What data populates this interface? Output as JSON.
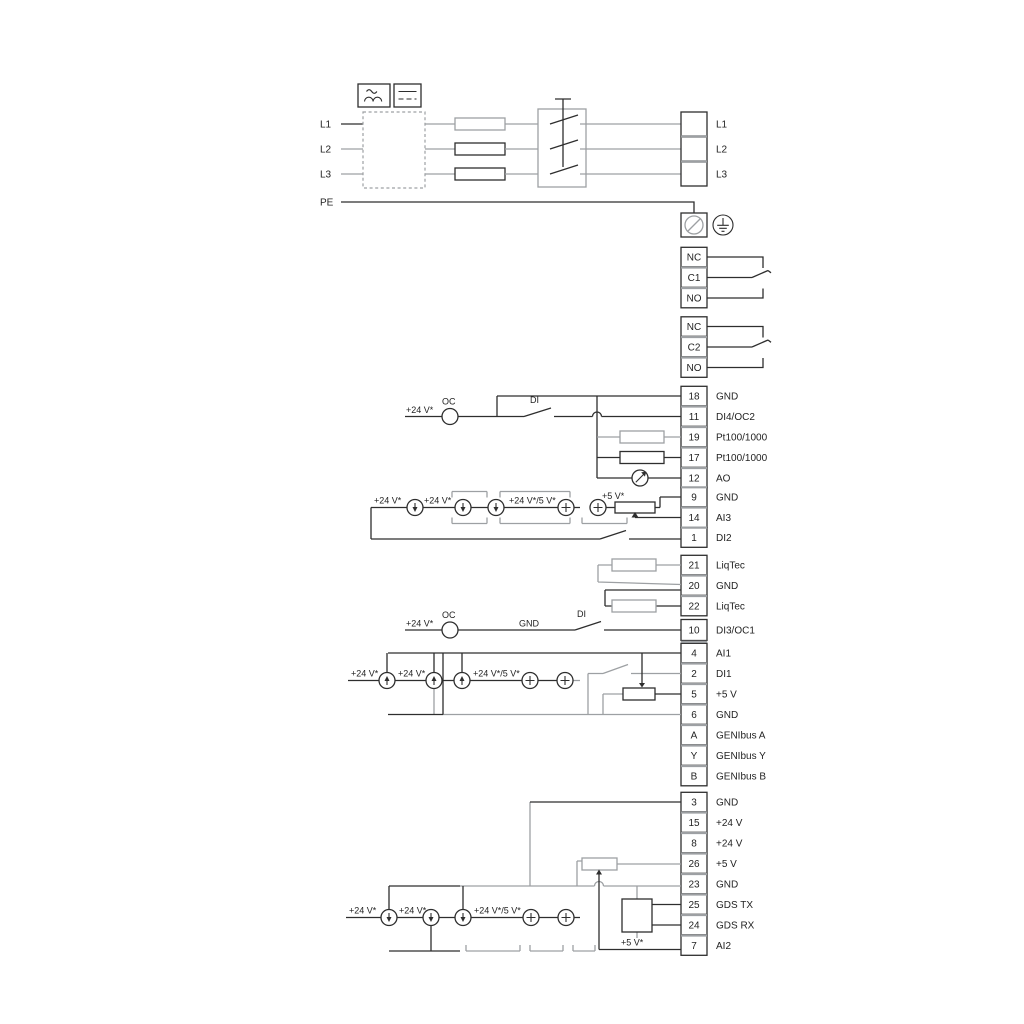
{
  "colors": {
    "line": "#2e2e2e",
    "gray": "#9da0a3",
    "background": "#ffffff"
  },
  "mains": {
    "inputs": [
      {
        "label": "L1"
      },
      {
        "label": "L2"
      },
      {
        "label": "L3"
      },
      {
        "label": "PE"
      }
    ],
    "outputs": [
      {
        "label": "L1"
      },
      {
        "label": "L2"
      },
      {
        "label": "L3"
      }
    ]
  },
  "relay1": {
    "terminals": [
      {
        "label": "NC"
      },
      {
        "label": "C1"
      },
      {
        "label": "NO"
      }
    ]
  },
  "relay2": {
    "terminals": [
      {
        "label": "NC"
      },
      {
        "label": "C2"
      },
      {
        "label": "NO"
      }
    ]
  },
  "strips": {
    "a": {
      "terminals": [
        {
          "num": "18",
          "label": "GND"
        },
        {
          "num": "11",
          "label": "DI4/OC2"
        },
        {
          "num": "19",
          "label": "Pt100/1000"
        },
        {
          "num": "17",
          "label": "Pt100/1000"
        },
        {
          "num": "12",
          "label": "AO"
        }
      ],
      "annotations": {
        "v24": "+24 V*",
        "oc": "OC",
        "di": "DI"
      }
    },
    "b": {
      "terminals": [
        {
          "num": "9",
          "label": "GND"
        },
        {
          "num": "14",
          "label": "AI3"
        },
        {
          "num": "1",
          "label": "DI2"
        }
      ],
      "annotations": {
        "v24_1": "+24 V*",
        "v24_2": "+24 V*",
        "v24_5": "+24 V*/5 V*",
        "v5": "+5 V*"
      }
    },
    "c": {
      "terminals": [
        {
          "num": "21",
          "label": "LiqTec"
        },
        {
          "num": "20",
          "label": "GND"
        },
        {
          "num": "22",
          "label": "LiqTec"
        }
      ]
    },
    "d": {
      "terminals": [
        {
          "num": "10",
          "label": "DI3/OC1"
        }
      ],
      "annotations": {
        "v24": "+24 V*",
        "oc": "OC",
        "gnd": "GND",
        "di": "DI"
      }
    },
    "e": {
      "terminals": [
        {
          "num": "4",
          "label": "AI1"
        },
        {
          "num": "2",
          "label": "DI1"
        },
        {
          "num": "5",
          "label": "+5 V"
        },
        {
          "num": "6",
          "label": "GND"
        },
        {
          "num": "A",
          "label": "GENIbus A"
        },
        {
          "num": "Y",
          "label": "GENIbus Y"
        },
        {
          "num": "B",
          "label": "GENIbus B"
        }
      ],
      "annotations": {
        "v24_1": "+24 V*",
        "v24_2": "+24 V*",
        "v24_5": "+24 V*/5 V*"
      }
    },
    "f": {
      "terminals": [
        {
          "num": "3",
          "label": "GND"
        },
        {
          "num": "15",
          "label": "+24 V"
        },
        {
          "num": "8",
          "label": "+24 V"
        },
        {
          "num": "26",
          "label": "+5 V"
        },
        {
          "num": "23",
          "label": "GND"
        },
        {
          "num": "25",
          "label": "GDS TX"
        },
        {
          "num": "24",
          "label": "GDS RX"
        },
        {
          "num": "7",
          "label": "AI2"
        }
      ],
      "annotations": {
        "v24_1": "+24 V*",
        "v24_2": "+24 V*",
        "v24_5": "+24 V*/5 V*",
        "v5": "+5 V*"
      }
    }
  }
}
